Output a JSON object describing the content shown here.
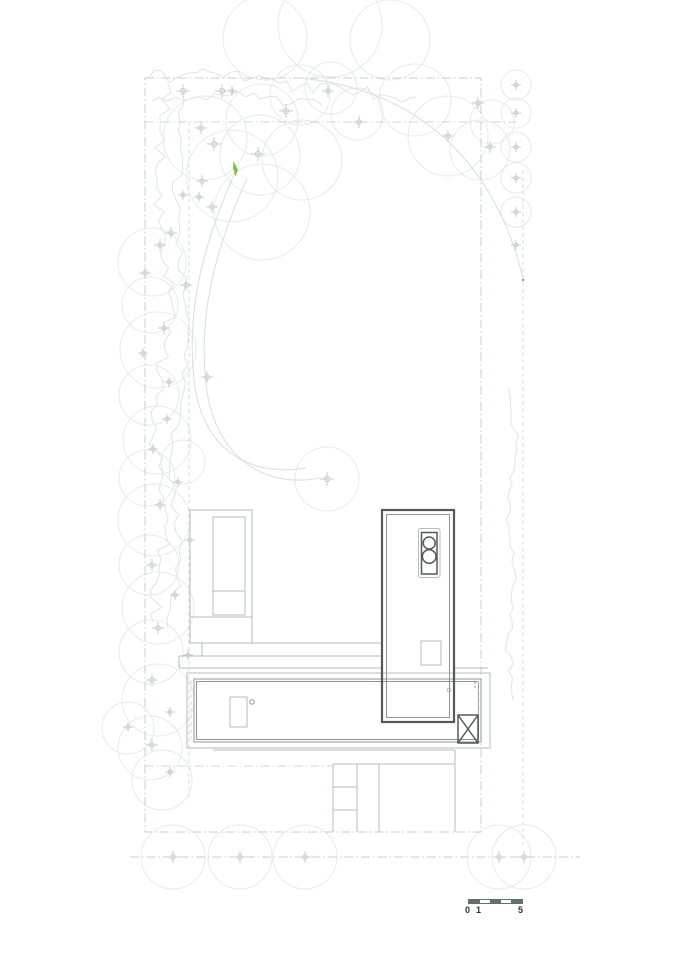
{
  "drawing": {
    "background": "#ffffff",
    "accent_green": "#7dc243",
    "line_colors": {
      "tree": "#e6ebe9",
      "cross": "#c6d0cc",
      "veg": "#dfe5e2",
      "bound": "#c6d0cd",
      "dash": "#d4dcd9",
      "arc": "#d8dfdc",
      "light": "#b7bebc",
      "mid": "#8f9593",
      "dark": "#54595a"
    },
    "trees": [
      [
        330,
        25,
        52
      ],
      [
        265,
        38,
        42
      ],
      [
        390,
        40,
        40
      ],
      [
        205,
        138,
        42
      ],
      [
        232,
        176,
        46
      ],
      [
        262,
        120,
        36
      ],
      [
        300,
        95,
        30
      ],
      [
        331,
        88,
        26
      ],
      [
        357,
        114,
        26
      ],
      [
        302,
        160,
        40
      ],
      [
        260,
        155,
        40
      ],
      [
        262,
        212,
        48
      ],
      [
        415,
        100,
        36
      ],
      [
        448,
        136,
        40
      ],
      [
        480,
        150,
        30
      ],
      [
        492,
        122,
        22
      ],
      [
        516,
        85,
        15
      ],
      [
        516,
        113,
        15
      ],
      [
        516,
        147,
        15
      ],
      [
        516,
        178,
        15
      ],
      [
        516,
        212,
        15
      ],
      [
        152,
        262,
        34
      ],
      [
        150,
        305,
        28
      ],
      [
        158,
        350,
        38
      ],
      [
        149,
        395,
        30
      ],
      [
        157,
        440,
        34
      ],
      [
        147,
        478,
        28
      ],
      [
        183,
        462,
        22
      ],
      [
        154,
        520,
        36
      ],
      [
        149,
        565,
        30
      ],
      [
        158,
        608,
        36
      ],
      [
        151,
        652,
        32
      ],
      [
        158,
        700,
        36
      ],
      [
        150,
        748,
        32
      ],
      [
        128,
        728,
        26
      ],
      [
        162,
        780,
        30
      ],
      [
        327,
        479,
        32
      ],
      [
        173,
        857,
        32
      ],
      [
        240,
        857,
        32
      ],
      [
        305,
        857,
        32
      ],
      [
        499,
        857,
        32
      ],
      [
        524,
        857,
        32
      ]
    ],
    "crosses": [
      [
        183,
        91,
        7
      ],
      [
        222,
        91,
        7
      ],
      [
        232,
        91,
        5
      ],
      [
        286,
        111,
        7
      ],
      [
        328,
        91,
        6
      ],
      [
        359,
        122,
        6
      ],
      [
        201,
        128,
        6
      ],
      [
        214,
        144,
        7
      ],
      [
        258,
        154,
        7
      ],
      [
        202,
        181,
        6
      ],
      [
        183,
        195,
        5
      ],
      [
        199,
        197,
        5
      ],
      [
        212,
        207,
        6
      ],
      [
        171,
        233,
        6
      ],
      [
        448,
        136,
        6
      ],
      [
        478,
        103,
        6
      ],
      [
        490,
        147,
        6
      ],
      [
        516,
        85,
        5
      ],
      [
        516,
        113,
        5
      ],
      [
        516,
        147,
        5
      ],
      [
        516,
        178,
        5
      ],
      [
        516,
        212,
        5
      ],
      [
        516,
        245,
        5
      ],
      [
        160,
        245,
        6
      ],
      [
        145,
        273,
        6
      ],
      [
        186,
        285,
        6
      ],
      [
        164,
        328,
        6
      ],
      [
        143,
        353,
        5
      ],
      [
        207,
        377,
        6
      ],
      [
        169,
        382,
        5
      ],
      [
        167,
        419,
        5
      ],
      [
        153,
        449,
        5
      ],
      [
        178,
        482,
        5
      ],
      [
        160,
        505,
        6
      ],
      [
        190,
        540,
        5
      ],
      [
        152,
        565,
        6
      ],
      [
        175,
        595,
        5
      ],
      [
        158,
        628,
        6
      ],
      [
        188,
        655,
        5
      ],
      [
        152,
        680,
        6
      ],
      [
        170,
        712,
        5
      ],
      [
        152,
        745,
        6
      ],
      [
        128,
        727,
        5
      ],
      [
        170,
        772,
        5
      ],
      [
        327,
        479,
        7
      ],
      [
        173,
        857,
        6
      ],
      [
        240,
        857,
        6
      ],
      [
        305,
        857,
        6
      ],
      [
        499,
        857,
        6
      ],
      [
        524,
        857,
        6
      ]
    ],
    "vegetation": [
      {
        "pts": [
          [
            148,
            78
          ],
          [
            210,
            72
          ],
          [
            300,
            86
          ],
          [
            360,
            92
          ],
          [
            416,
            97
          ]
        ],
        "amp": 7,
        "step": 7
      },
      {
        "pts": [
          [
            152,
            101
          ],
          [
            230,
            95
          ],
          [
            322,
            105
          ]
        ],
        "amp": 5,
        "step": 8
      },
      {
        "pts": [
          [
            168,
            84
          ],
          [
            157,
            180
          ],
          [
            172,
            300
          ],
          [
            152,
            420
          ],
          [
            168,
            520
          ],
          [
            153,
            622
          ]
        ],
        "amp": 7,
        "step": 8
      },
      {
        "pts": [
          [
            184,
            96
          ],
          [
            176,
            200
          ],
          [
            188,
            330
          ],
          [
            170,
            460
          ],
          [
            181,
            560
          ],
          [
            168,
            628
          ]
        ],
        "amp": 5,
        "step": 9
      },
      {
        "pts": [
          [
            509,
            388
          ],
          [
            517,
            450
          ],
          [
            506,
            520
          ],
          [
            516,
            580
          ],
          [
            508,
            635
          ],
          [
            513,
            700
          ]
        ],
        "amp": 4,
        "step": 7
      }
    ]
  },
  "scale_bar": {
    "labels": {
      "zero": "0",
      "one": "1",
      "five": "5"
    },
    "segments": 5,
    "bar_color": "#5f7270",
    "text_color": "#2e3331"
  }
}
